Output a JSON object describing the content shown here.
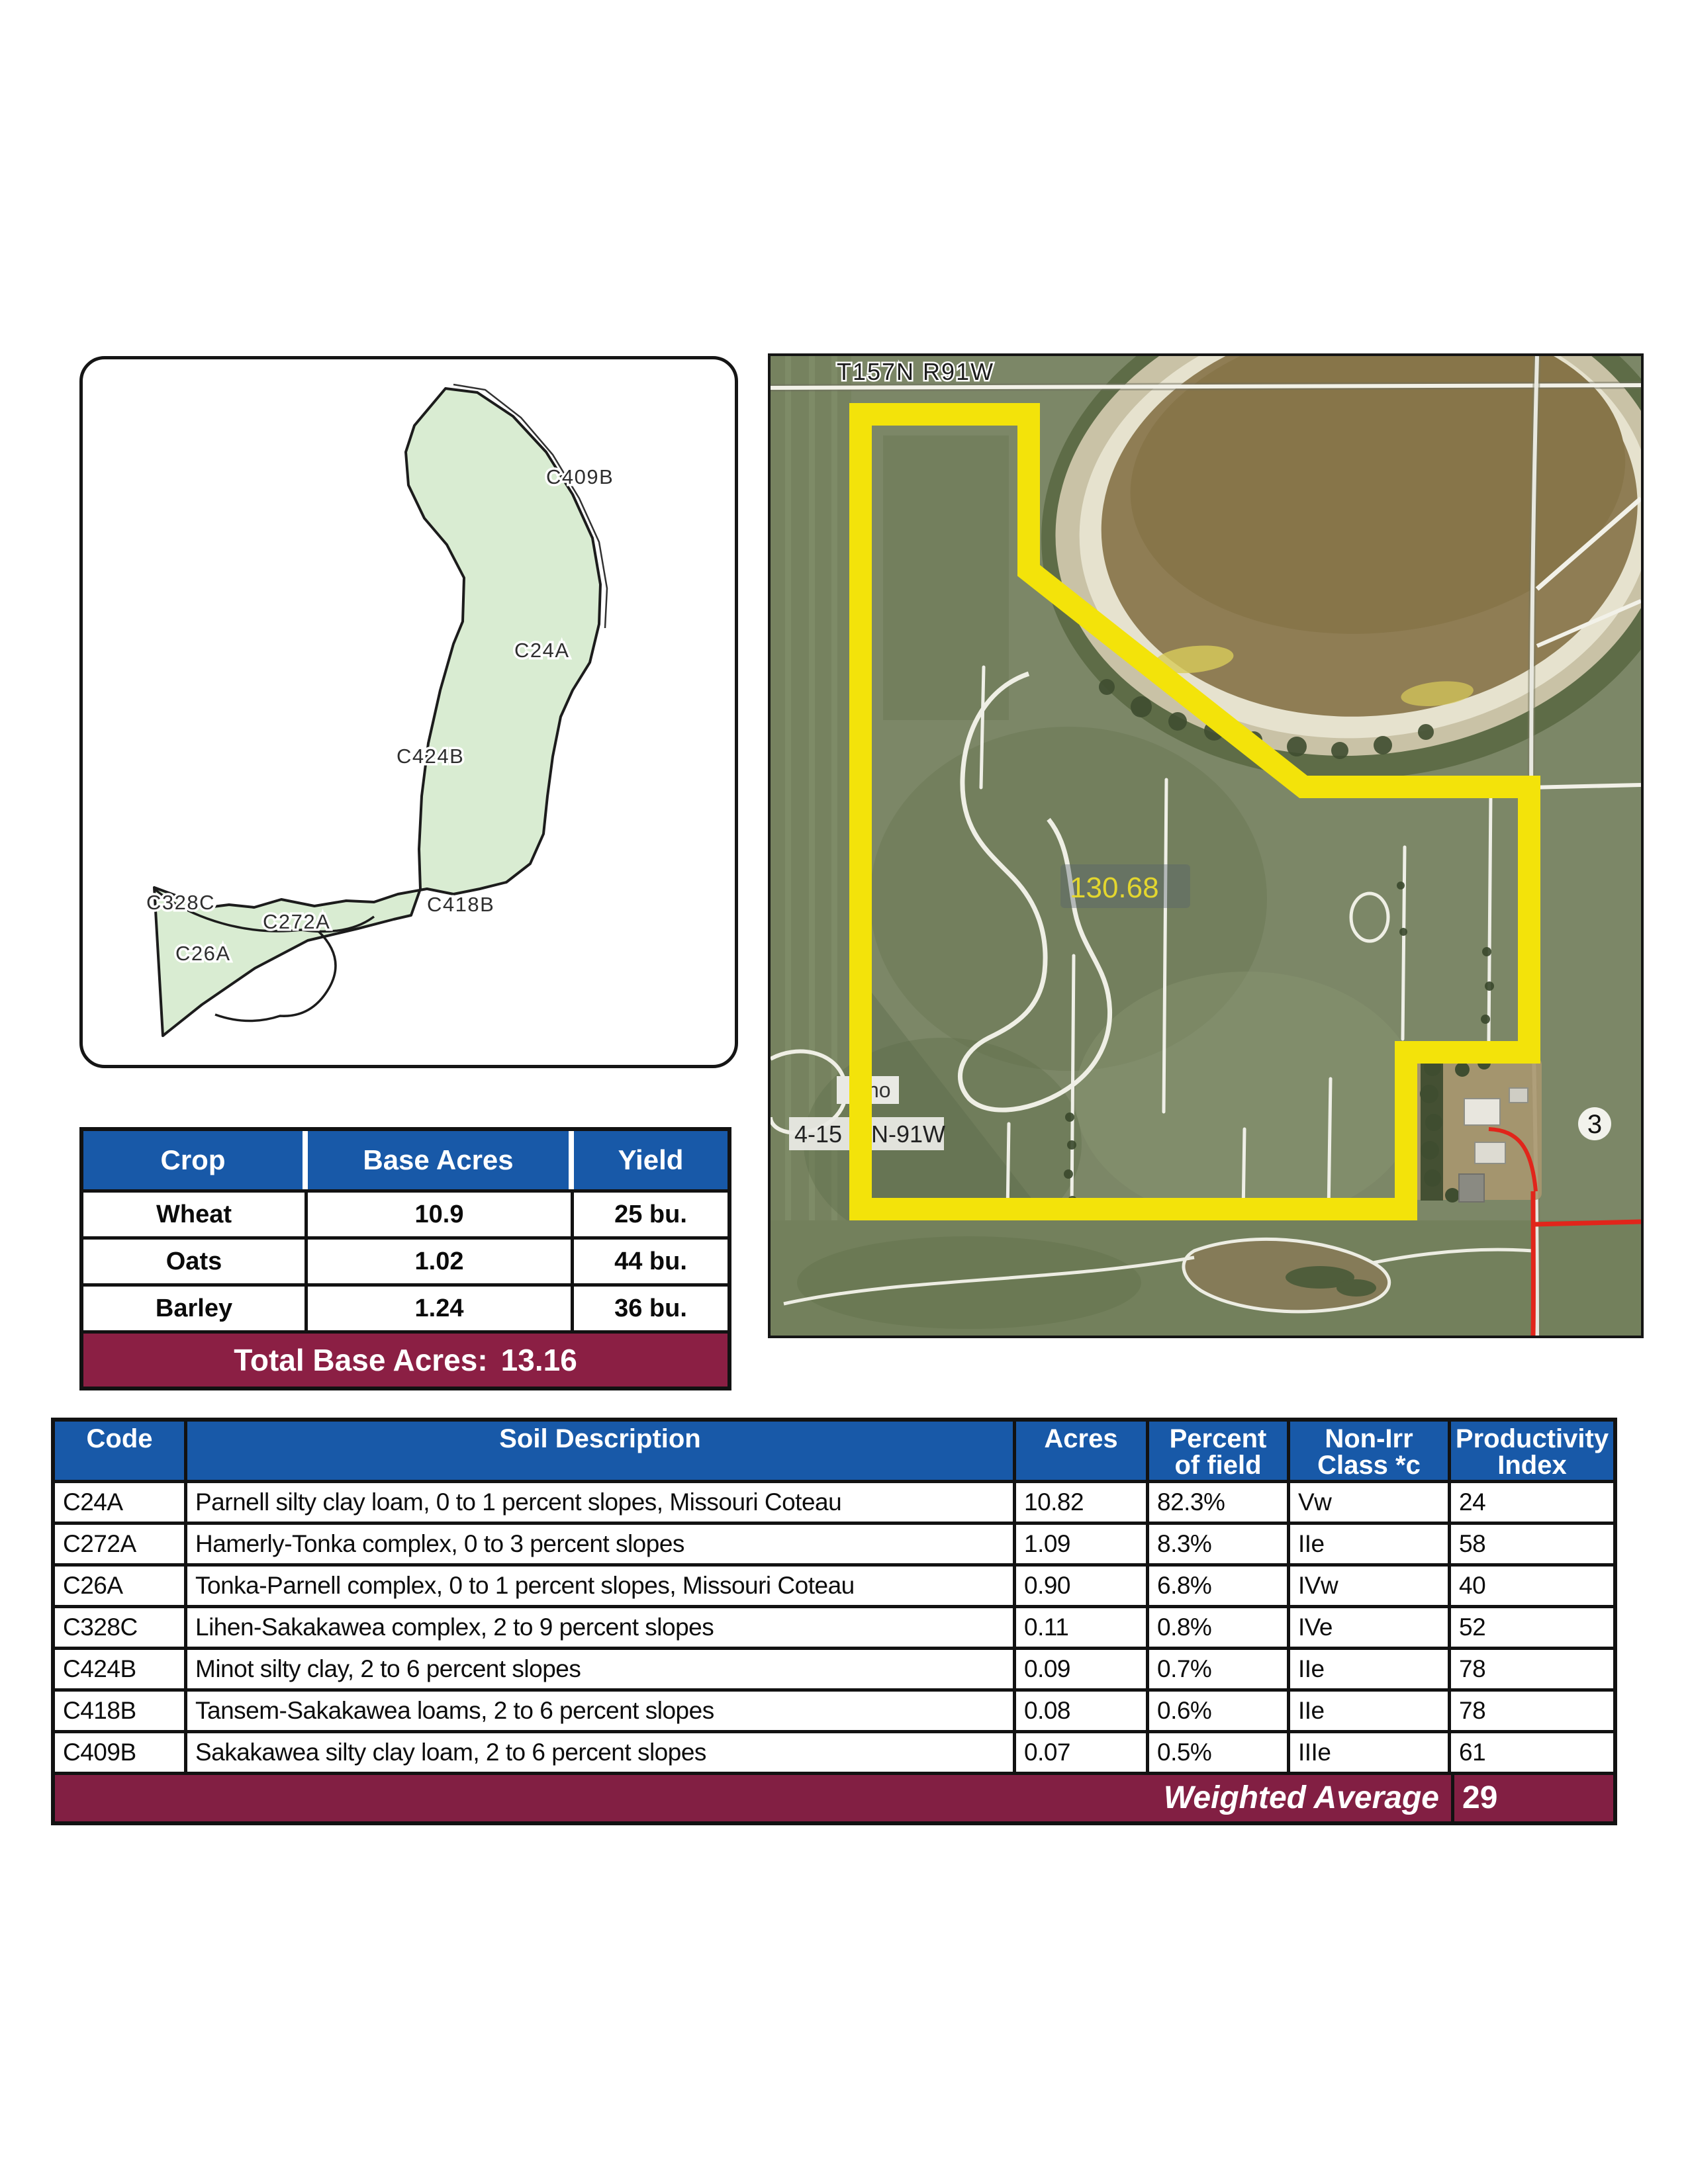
{
  "map": {
    "labels": [
      {
        "text": "C409B"
      },
      {
        "text": "C24A"
      },
      {
        "text": "C424B"
      },
      {
        "text": "C328C"
      },
      {
        "text": "C272A"
      },
      {
        "text": "C26A"
      },
      {
        "text": "C418B"
      }
    ]
  },
  "photo": {
    "township": "T157N R91W",
    "area_value": "130.68",
    "marker_ho": "ho",
    "section_prefix": "4-15",
    "section_suffix": "N-91W",
    "section_number": "3"
  },
  "crop_table": {
    "headers": [
      "Crop",
      "Base Acres",
      "Yield"
    ],
    "rows": [
      [
        "Wheat",
        "10.9",
        "25 bu."
      ],
      [
        "Oats",
        "1.02",
        "44 bu."
      ],
      [
        "Barley",
        "1.24",
        "36 bu."
      ]
    ],
    "footer_label": "Total Base Acres:",
    "footer_value": "13.16"
  },
  "soil_table": {
    "headers": [
      {
        "l1": "Code",
        "l2": ""
      },
      {
        "l1": "Soil Description",
        "l2": ""
      },
      {
        "l1": "Acres",
        "l2": ""
      },
      {
        "l1": "Percent",
        "l2": "of field"
      },
      {
        "l1": "Non-Irr",
        "l2": "Class *c"
      },
      {
        "l1": "Productivity",
        "l2": "Index"
      }
    ],
    "rows": [
      [
        "C24A",
        "Parnell silty clay loam, 0 to 1 percent slopes, Missouri Coteau",
        "10.82",
        "82.3%",
        "Vw",
        "24"
      ],
      [
        "C272A",
        "Hamerly-Tonka complex, 0 to 3 percent slopes",
        "1.09",
        "8.3%",
        "IIe",
        "58"
      ],
      [
        "C26A",
        "Tonka-Parnell complex, 0 to 1 percent slopes, Missouri Coteau",
        "0.90",
        "6.8%",
        "IVw",
        "40"
      ],
      [
        "C328C",
        "Lihen-Sakakawea complex, 2 to 9 percent slopes",
        "0.11",
        "0.8%",
        "IVe",
        "52"
      ],
      [
        "C424B",
        "Minot silty clay, 2 to 6 percent slopes",
        "0.09",
        "0.7%",
        "IIe",
        "78"
      ],
      [
        "C418B",
        "Tansem-Sakakawea loams, 2 to 6 percent slopes",
        "0.08",
        "0.6%",
        "IIe",
        "78"
      ],
      [
        "C409B",
        "Sakakawea silty clay loam, 2 to 6 percent slopes",
        "0.07",
        "0.5%",
        "IIIe",
        "61"
      ]
    ],
    "footer_label": "Weighted Average",
    "footer_value": "29"
  },
  "colors": {
    "header_blue": "#1859A8",
    "footer_maroon": "#851F43",
    "boundary_yellow": "#F3E30A",
    "soil_polygon_green": "#D9ECD2",
    "pond_brown": "#8F7D54",
    "road_red": "#E1251B"
  }
}
